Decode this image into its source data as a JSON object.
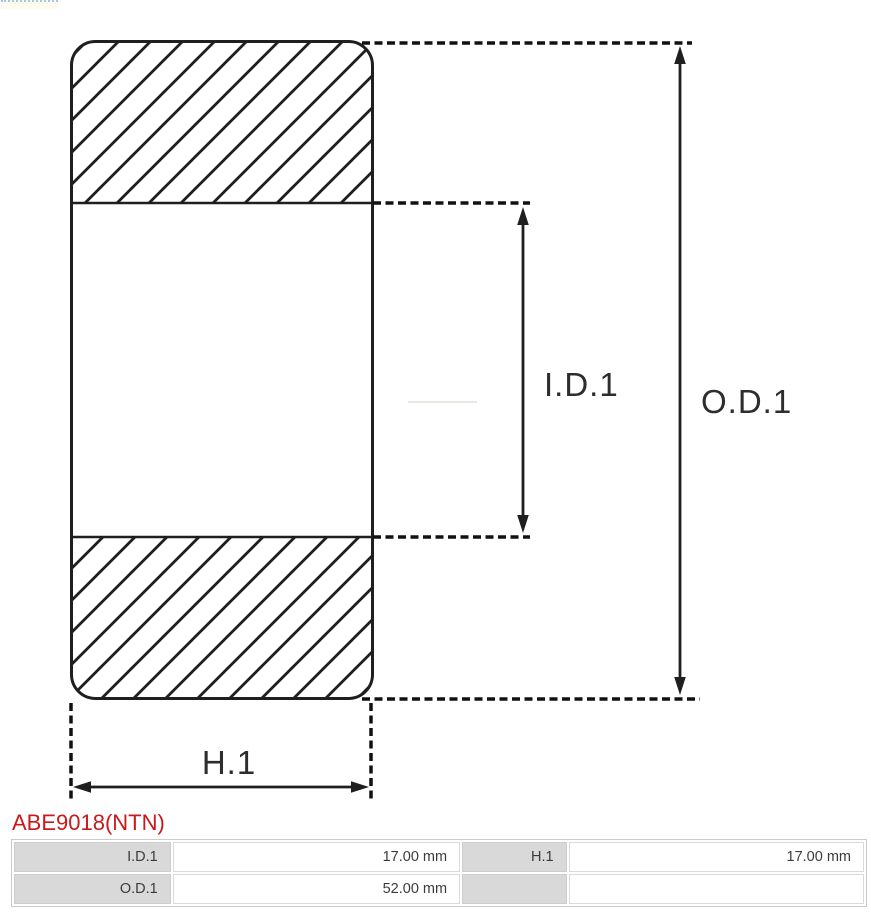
{
  "diagram": {
    "labels": {
      "inner_diameter": "I.D.1",
      "outer_diameter": "O.D.1",
      "height": "H.1"
    },
    "stroke_color": "#1f1f1f"
  },
  "part_number": {
    "text": "ABE9018(NTN)",
    "color": "#c9191c"
  },
  "dimensions_table": {
    "label_bg": "#d9d9d9",
    "rows": [
      {
        "cells": [
          {
            "label": "I.D.1",
            "value": "17.00 mm"
          },
          {
            "label": "H.1",
            "value": "17.00 mm"
          }
        ]
      },
      {
        "cells": [
          {
            "label": "O.D.1",
            "value": "52.00 mm"
          },
          {
            "label": "",
            "value": ""
          }
        ]
      }
    ]
  }
}
